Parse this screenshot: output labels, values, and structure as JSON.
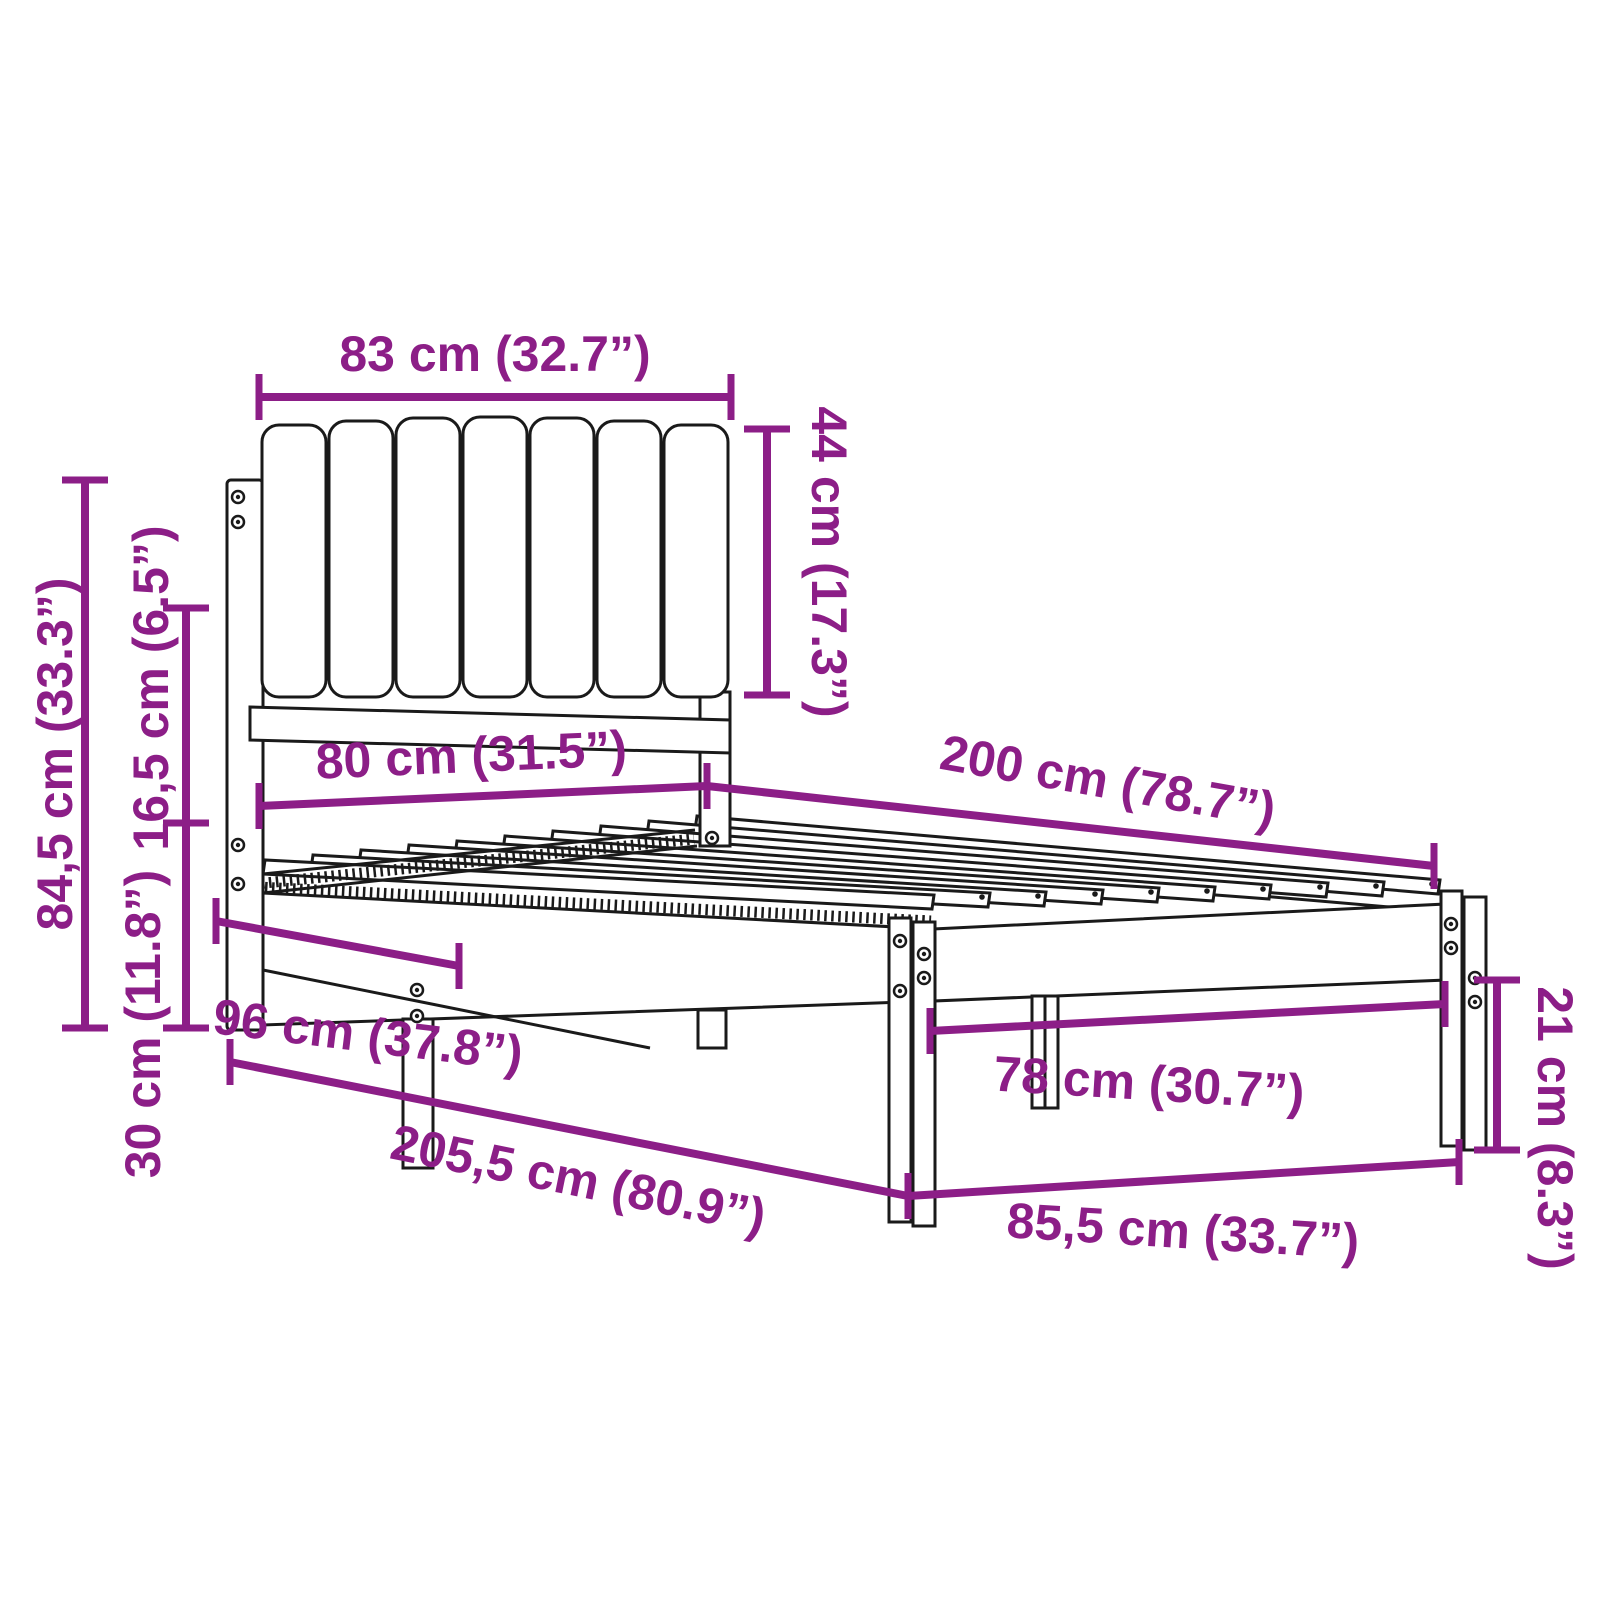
{
  "diagram": {
    "subject": "bed-frame-with-upholstered-headboard-dimension-diagram",
    "style": {
      "accent_color": "#8C1E87",
      "line_color": "#1A1A1A",
      "background": "#FFFFFF"
    },
    "dimensions": [
      {
        "id": "headboard-width",
        "label": "83 cm (32.7”)"
      },
      {
        "id": "headboard-panel-height",
        "label": "44 cm (17.3”)"
      },
      {
        "id": "headboard-total-height",
        "label": "84,5 cm (33.3”)"
      },
      {
        "id": "side-rail-height",
        "label": "16,5 cm (6.5”)"
      },
      {
        "id": "frame-inner-width",
        "label": "80 cm (31.5”)"
      },
      {
        "id": "frame-length",
        "label": "200 cm (78.7”)"
      },
      {
        "id": "base-height",
        "label": "30 cm (11.8”)"
      },
      {
        "id": "head-end-depth",
        "label": "96 cm (37.8”)"
      },
      {
        "id": "total-length",
        "label": "205,5 cm (80.9”)"
      },
      {
        "id": "foot-inner-width",
        "label": "78 cm (30.7”)"
      },
      {
        "id": "foot-leg-height",
        "label": "21 cm (8.3”)"
      },
      {
        "id": "foot-total-width",
        "label": "85,5 cm (33.7”)"
      }
    ]
  }
}
